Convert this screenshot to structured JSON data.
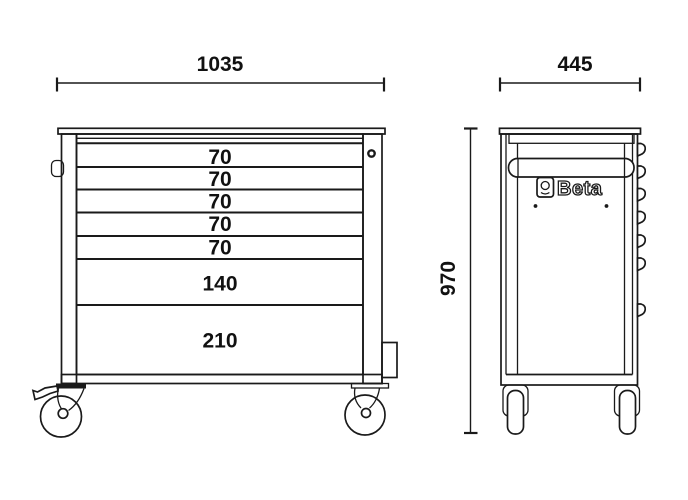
{
  "colors": {
    "background": "#ffffff",
    "line": "#1a1a1a",
    "text": "#111111"
  },
  "front_view": {
    "width_dimension": "1035",
    "drawers": [
      {
        "height": "70"
      },
      {
        "height": "70"
      },
      {
        "height": "70"
      },
      {
        "height": "70"
      },
      {
        "height": "70"
      },
      {
        "height": "140"
      },
      {
        "height": "210"
      }
    ]
  },
  "side_view": {
    "width_dimension": "445",
    "height_dimension": "970",
    "brand": "Beta"
  }
}
